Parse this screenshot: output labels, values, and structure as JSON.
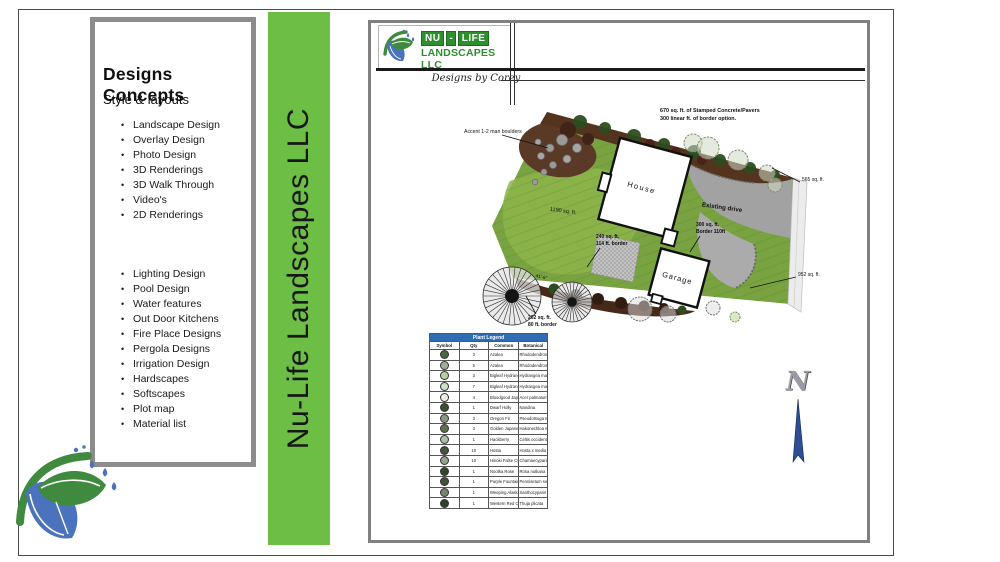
{
  "left_panel": {
    "title": "Designs Concepts",
    "subtitle": "Style & layouts",
    "list1": [
      "Landscape Design",
      "Overlay Design",
      "Photo  Design",
      "3D Renderings",
      "3D Walk Through",
      "Video's",
      "2D Renderings"
    ],
    "list2": [
      "Lighting Design",
      "Pool Design",
      "Water features",
      "Out Door Kitchens",
      "Fire Place Designs",
      "Pergola Designs",
      "Irrigation Design",
      "Hardscapes",
      "Softscapes",
      "Plot map",
      "Material list"
    ]
  },
  "banner": {
    "text": "Nu-Life Landscapes LLC",
    "color": "#6cbe45"
  },
  "header": {
    "logo_name_1": "NU",
    "logo_dash": "-",
    "logo_name_2": "LIFE",
    "logo_sub": "LANDSCAPES LLC",
    "tagline": "Designs by Corey"
  },
  "plan": {
    "note_line1": "670 sq. ft. of Stamped Concrete/Pavers",
    "note_line2": "300 linear ft. of border option.",
    "boulders_label": "Accent 1-2 man boulders",
    "house_label": "House",
    "garage_label": "Garage",
    "drive_label": "Existing drive",
    "area_1190": "1190 sq. ft.",
    "area_240a": "240 sq. ft.",
    "area_240b": "114 ft. border",
    "area_202a": "202 sq. ft.",
    "area_202b": "80 ft. border",
    "area_300a": "300 sq. ft.",
    "area_300b": "Border 110ft",
    "area_565": "565 sq. ft.",
    "area_952": "952 sq. ft.",
    "dim_41": "41'-6\"",
    "compass_n": "N",
    "colors": {
      "lawn": "#79a340",
      "bed": "#54341f",
      "drive": "#a2a2a2",
      "walk": "#ececec"
    }
  },
  "legend": {
    "title": "Plant Legend",
    "columns": [
      "Symbol",
      "Qty",
      "Common",
      "Botanical"
    ],
    "rows": [
      {
        "qty": "3",
        "common": "Azalea",
        "botanical": "Rhododendron",
        "sym": "#4a6741"
      },
      {
        "qty": "5",
        "common": "Azalea",
        "botanical": "Rhododendron",
        "sym": "#9fae9b"
      },
      {
        "qty": "3",
        "common": "Bigleaf Hydrangea",
        "botanical": "Hydrangea macrophylla 'Endless Summer'",
        "sym": "#b5cfa2"
      },
      {
        "qty": "7",
        "common": "Bigleaf Hydrangea",
        "botanical": "Hydrangea macrophylla 'Nikko Blue'",
        "sym": "#cfe0c2"
      },
      {
        "qty": "4",
        "common": "Bloodgood Japanese Maple",
        "botanical": "Acer palmatum 'Bloodgood'",
        "sym": "#e9efe4"
      },
      {
        "qty": "1",
        "common": "Dwarf Holly",
        "botanical": "Nandina",
        "sym": "#3a4f33"
      },
      {
        "qty": "3",
        "common": "Oregon Fir",
        "botanical": "Pseudotsuga menziesii",
        "sym": "#8a9a84"
      },
      {
        "qty": "3",
        "common": "Golden Japanese Forest Grass",
        "botanical": "Hakonechloa macra 'Aureola'",
        "sym": "#5d7050"
      },
      {
        "qty": "1",
        "common": "Hackberry",
        "botanical": "Celtis occidentalis",
        "sym": "#aebfa8"
      },
      {
        "qty": "10",
        "common": "Hosta",
        "botanical": "Hosta x media 'Halcyon'",
        "sym": "#41543c"
      },
      {
        "qty": "10",
        "common": "Hinoki False Cypress",
        "botanical": "Chamaecyparis obtusa 'Nana'",
        "sym": "#93a38c"
      },
      {
        "qty": "1",
        "common": "Nootka Rose",
        "botanical": "Rosa nutkana",
        "sym": "#32462c"
      },
      {
        "qty": "1",
        "common": "Purple Fountain Grass",
        "botanical": "Pennisetum setaceum",
        "sym": "#3f5339"
      },
      {
        "qty": "1",
        "common": "Weeping Alaska Cypress",
        "botanical": "Xanthocyparis nootkatensis 'Pendula'",
        "sym": "#76866f"
      },
      {
        "qty": "1",
        "common": "Western Red Cedar",
        "botanical": "Thuja plicata",
        "sym": "#2f4129"
      }
    ]
  }
}
